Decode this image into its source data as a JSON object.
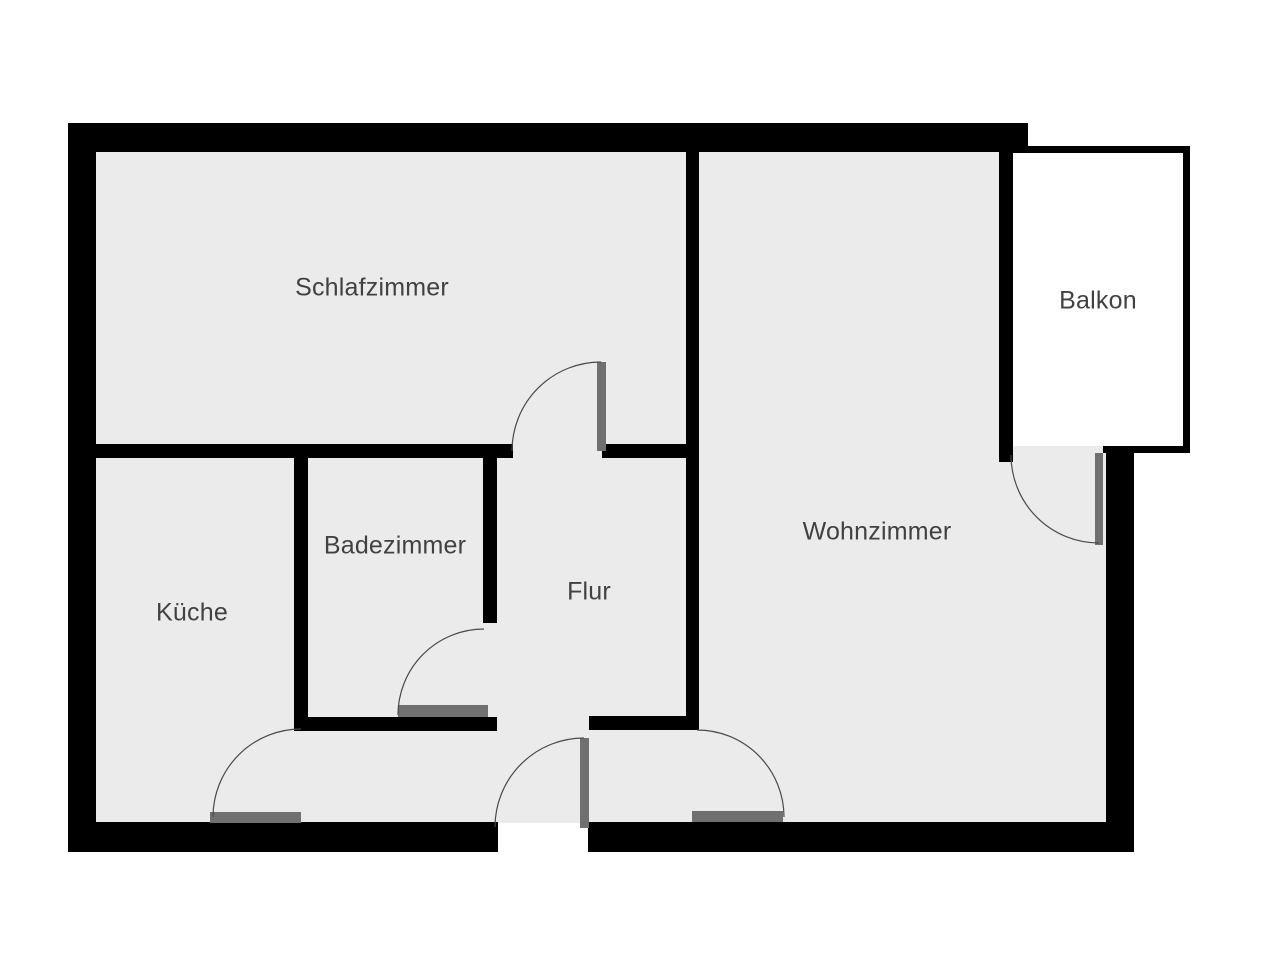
{
  "title": "Apartment floor plan",
  "floorplan": {
    "canvas": {
      "width": 1280,
      "height": 960
    },
    "colors": {
      "background": "#ffffff",
      "wall": "#000000",
      "floor": "#ebebeb",
      "balcony_floor": "#ffffff",
      "door_leaf": "#707070",
      "swing_arc": "#4a4a4a",
      "label_text": "#414141"
    },
    "rooms": [
      {
        "id": "schlafzimmer",
        "label": "Schlafzimmer",
        "label_x": 372,
        "label_y": 288
      },
      {
        "id": "kueche",
        "label": "Küche",
        "label_x": 192,
        "label_y": 613
      },
      {
        "id": "badezimmer",
        "label": "Badezimmer",
        "label_x": 395,
        "label_y": 546
      },
      {
        "id": "flur",
        "label": "Flur",
        "label_x": 589,
        "label_y": 592
      },
      {
        "id": "wohnzimmer",
        "label": "Wohnzimmer",
        "label_x": 877,
        "label_y": 532
      },
      {
        "id": "balkon",
        "label": "Balkon",
        "label_x": 1098,
        "label_y": 301
      }
    ],
    "floors": [
      {
        "id": "floor-main-left",
        "x": 96,
        "y": 152,
        "w": 903,
        "h": 671,
        "fill": "floor"
      },
      {
        "id": "floor-wohnzimmer-right",
        "x": 999,
        "y": 446,
        "w": 107,
        "h": 377,
        "fill": "floor"
      },
      {
        "id": "floor-balkon",
        "x": 1013,
        "y": 153,
        "w": 170,
        "h": 293,
        "fill": "balcony_floor"
      }
    ],
    "walls": [
      {
        "id": "outer-top",
        "x": 68,
        "y": 123,
        "w": 960,
        "h": 29
      },
      {
        "id": "outer-left",
        "x": 68,
        "y": 123,
        "w": 28,
        "h": 729
      },
      {
        "id": "outer-bottom-left",
        "x": 68,
        "y": 822,
        "w": 430,
        "h": 30
      },
      {
        "id": "outer-bottom-right",
        "x": 588,
        "y": 822,
        "w": 546,
        "h": 30
      },
      {
        "id": "outer-right-lower",
        "x": 1106,
        "y": 446,
        "w": 28,
        "h": 406
      },
      {
        "id": "schlafzimmer-bottom-left",
        "x": 96,
        "y": 444,
        "w": 417,
        "h": 14
      },
      {
        "id": "schlafzimmer-bottom-right",
        "x": 602,
        "y": 444,
        "w": 84,
        "h": 14
      },
      {
        "id": "wohnzimmer-left",
        "x": 686,
        "y": 152,
        "w": 13,
        "h": 578
      },
      {
        "id": "badezimmer-left",
        "x": 294,
        "y": 458,
        "w": 14,
        "h": 273
      },
      {
        "id": "badezimmer-right",
        "x": 483,
        "y": 458,
        "w": 14,
        "h": 165
      },
      {
        "id": "badezimmer-bottom",
        "x": 294,
        "y": 717,
        "w": 203,
        "h": 14
      },
      {
        "id": "flur-bottom-stub",
        "x": 589,
        "y": 716,
        "w": 110,
        "h": 14
      },
      {
        "id": "wohnzimmer-balkon",
        "x": 999,
        "y": 152,
        "w": 14,
        "h": 310
      },
      {
        "id": "balkon-top",
        "x": 1013,
        "y": 146,
        "w": 177,
        "h": 7
      },
      {
        "id": "balkon-right",
        "x": 1183,
        "y": 146,
        "w": 7,
        "h": 307
      },
      {
        "id": "balkon-bottom",
        "x": 1103,
        "y": 446,
        "w": 87,
        "h": 7
      }
    ],
    "door_leaves": [
      {
        "id": "door-leaf-schlafzimmer",
        "x": 597,
        "y": 362,
        "w": 9,
        "h": 89
      },
      {
        "id": "door-leaf-badezimmer",
        "x": 398,
        "y": 705,
        "w": 90,
        "h": 12
      },
      {
        "id": "door-leaf-kueche",
        "x": 210,
        "y": 812,
        "w": 91,
        "h": 11
      },
      {
        "id": "door-leaf-entrance",
        "x": 580,
        "y": 738,
        "w": 9,
        "h": 90
      },
      {
        "id": "door-leaf-wohnzimmer",
        "x": 692,
        "y": 811,
        "w": 91,
        "h": 11
      },
      {
        "id": "door-leaf-balkon",
        "x": 1095,
        "y": 453,
        "w": 8,
        "h": 92
      }
    ],
    "door_arcs": [
      {
        "id": "door-arc-schlafzimmer",
        "d": "M 512 451 A 89 89 0 0 1 601 362"
      },
      {
        "id": "door-arc-badezimmer",
        "d": "M 398 715 A 86 86 0 0 1 484 629"
      },
      {
        "id": "door-arc-kueche",
        "d": "M 213 817 A 88 88 0 0 1 301 729"
      },
      {
        "id": "door-arc-entrance",
        "d": "M 584 738 A 89 89 0 0 0 495 827"
      },
      {
        "id": "door-arc-wohnzimmer",
        "d": "M 697 730 A 87 87 0 0 1 784 817"
      },
      {
        "id": "door-arc-balkon",
        "d": "M 1011 455 A 88 88 0 0 0 1099 543"
      }
    ]
  }
}
